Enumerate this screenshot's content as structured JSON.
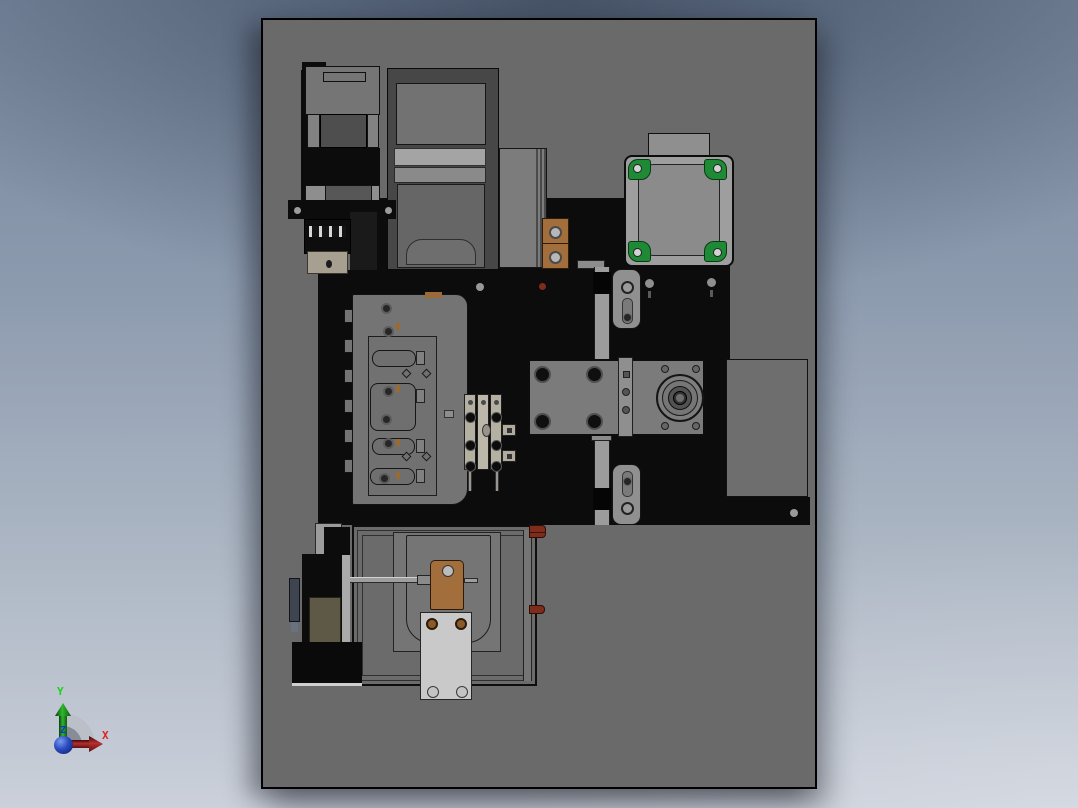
{
  "viewport": {
    "type": "cad-3d-viewport",
    "view_orientation": "top",
    "background_top_color": "#76869c",
    "background_bottom_color": "#cbd0da"
  },
  "base_plate": {
    "color": "#6a6a6a",
    "border_color": "#000000"
  },
  "axis_triad": {
    "x": {
      "label": "X",
      "color": "#e02020"
    },
    "y": {
      "label": "Y",
      "color": "#19d419"
    },
    "z": {
      "label": "Z",
      "color": "#1a2fd4"
    },
    "arc_color": "#b9bec6",
    "arc_inner_color": "#878d96",
    "origin_sphere_color": "#1c3bb0"
  },
  "part_colors": {
    "black_structure": "#0c0c0c",
    "gray_block": "#7b7b7b",
    "motor_body": "#9e9e9e",
    "motor_mount_green": "#1f8a36",
    "copper_block": "#a26e3c",
    "red_peg": "#7e2d1c",
    "tool_block_beige": "#b4b0a2",
    "olive_panel": "#5e5947",
    "light_mount_plate": "#c9c9c9",
    "rail_gray": "#9c9c9c"
  },
  "components": [
    "machine-base-plate",
    "black-mounting-platform",
    "left-actuator-stack",
    "center-gearbox-stack",
    "stepper-motor-top-right",
    "copper-spacer-block",
    "clamp-fixture-plate",
    "tool-block",
    "gear-block-with-flange-bearing",
    "guide-rail-with-slotted-brackets",
    "right-side-plate",
    "conveyor-tray",
    "copper-bracket",
    "bottom-mounting-plate",
    "left-drive-motor",
    "axis-triad"
  ]
}
